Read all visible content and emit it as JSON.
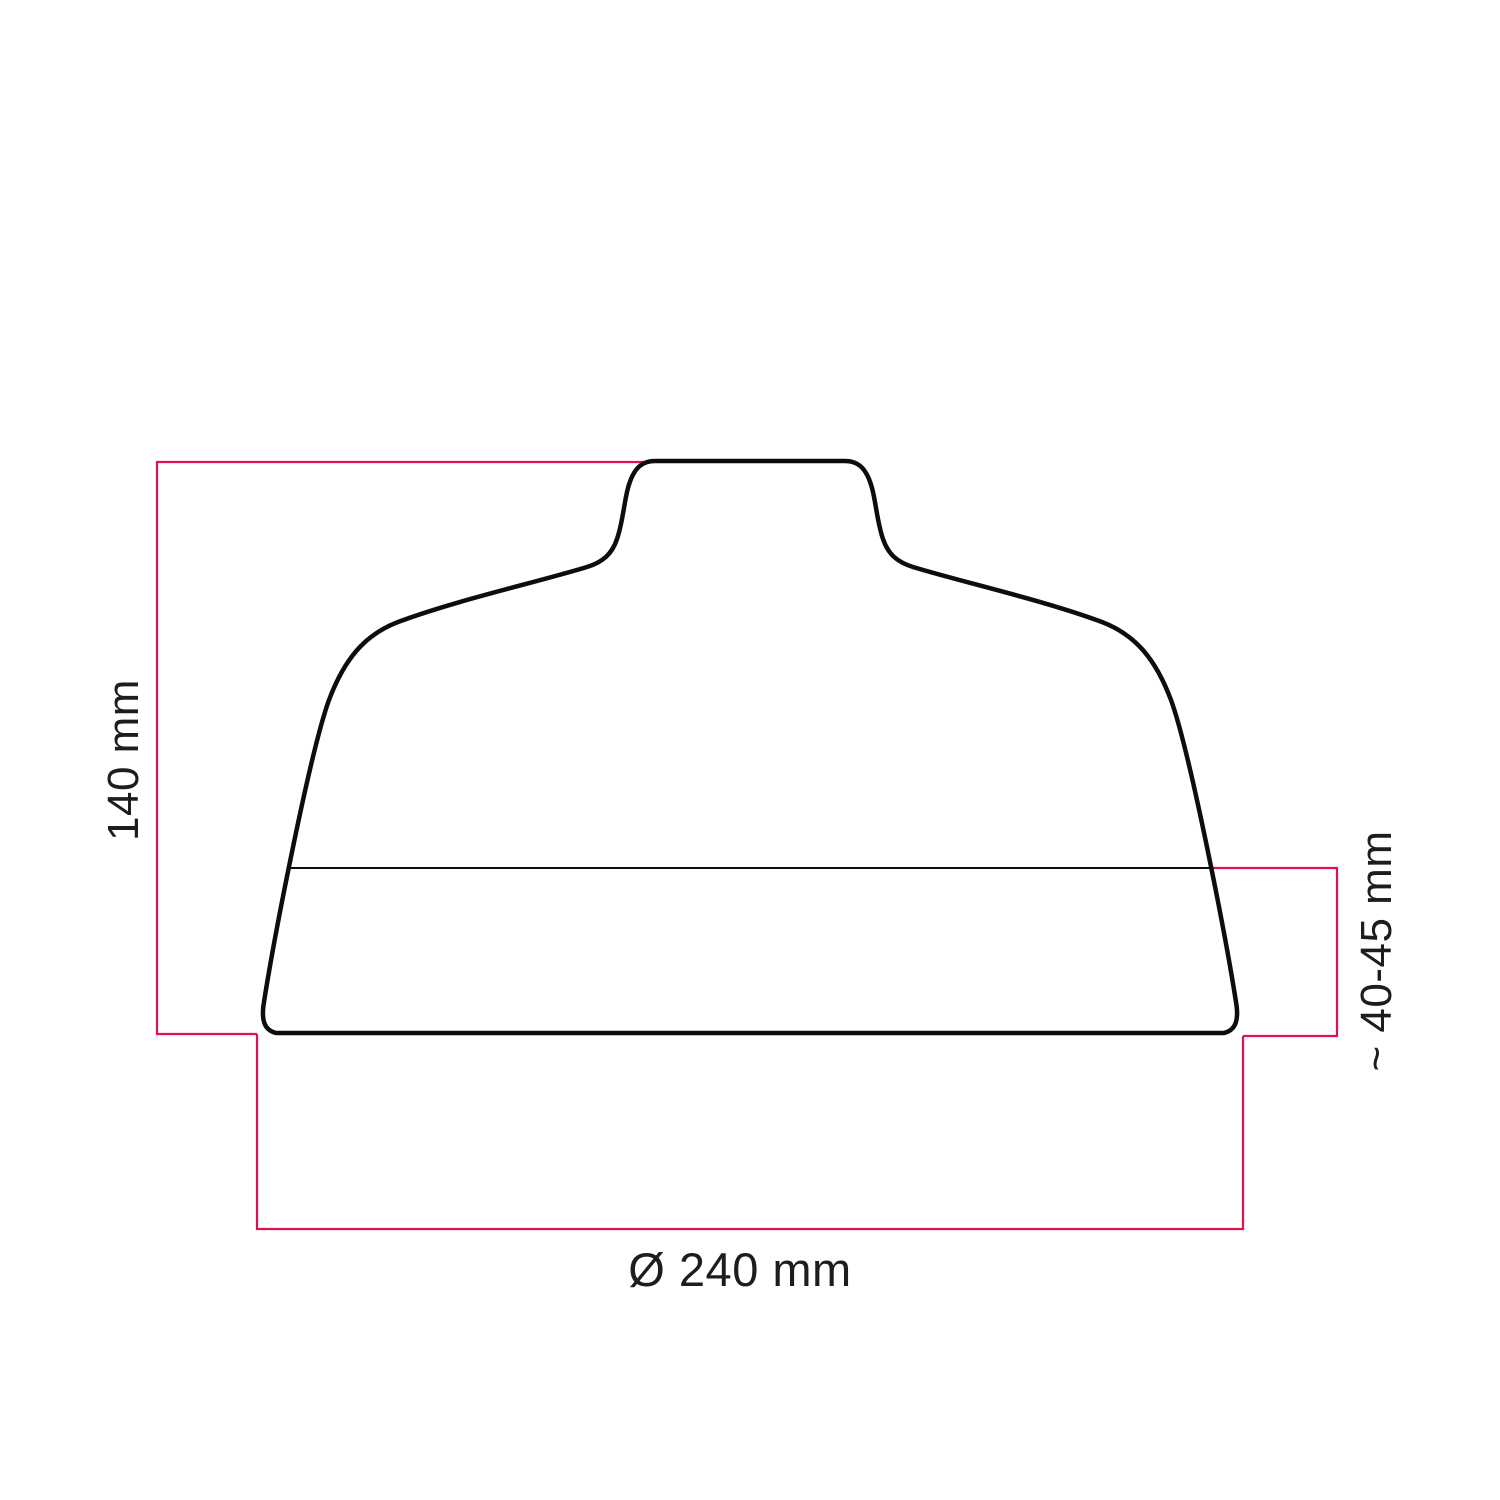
{
  "diagram": {
    "labels": {
      "height": "140 mm",
      "neck_height": "~ 40-45 mm",
      "diameter": "Ø 240 mm"
    },
    "colors": {
      "dimension": "#e0114d",
      "outline": "#0d0d0d",
      "text": "#1d1d1b"
    }
  }
}
